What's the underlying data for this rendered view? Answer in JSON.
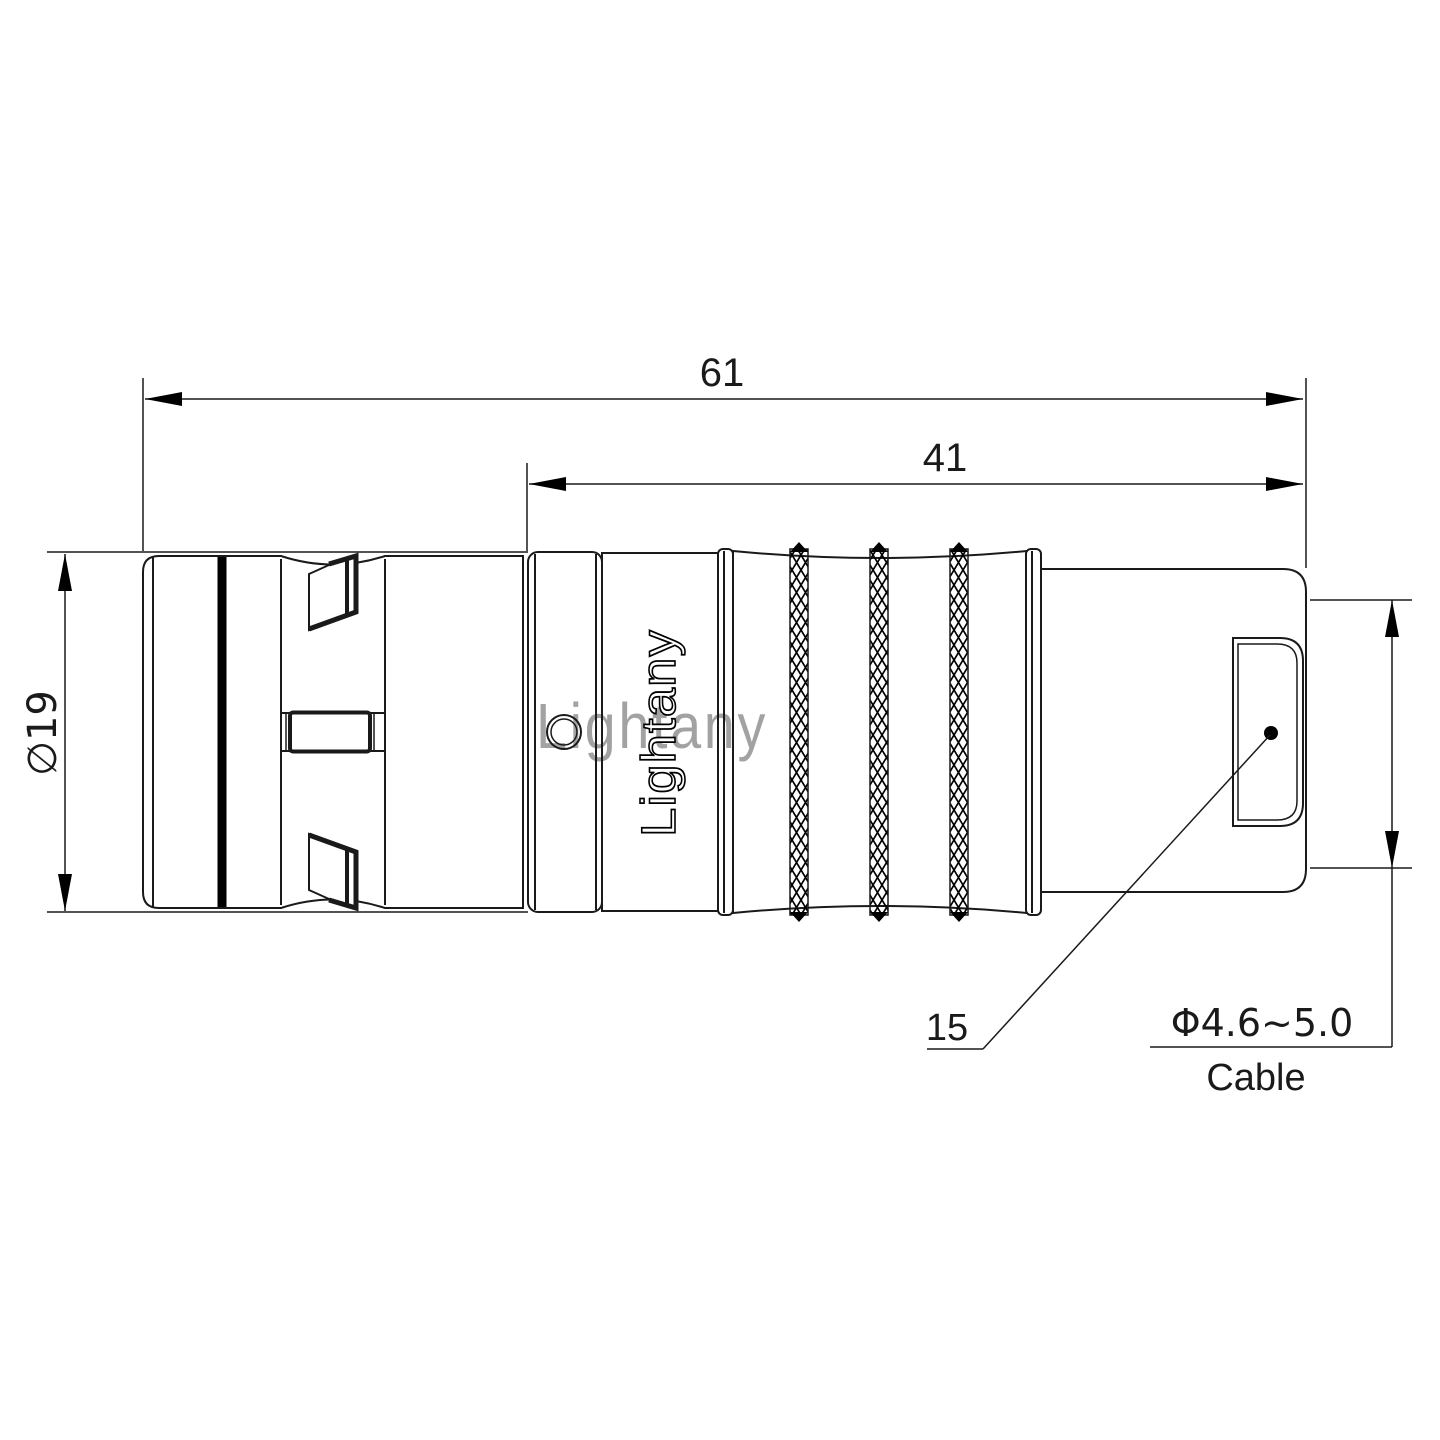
{
  "drawing": {
    "type": "connector-technical-drawing",
    "brand_logo": "Lightany",
    "watermark": "Lightany",
    "dimensions": {
      "overall_length": "61",
      "rear_length": "41",
      "body_diameter": "∅19",
      "ref_number": "15",
      "cable_diameter_range": "Φ4.6~5.0",
      "cable_label": "Cable"
    },
    "colors": {
      "line": "#1a1a1a",
      "watermark_pink": "#e98b8b",
      "background": "#ffffff"
    }
  }
}
